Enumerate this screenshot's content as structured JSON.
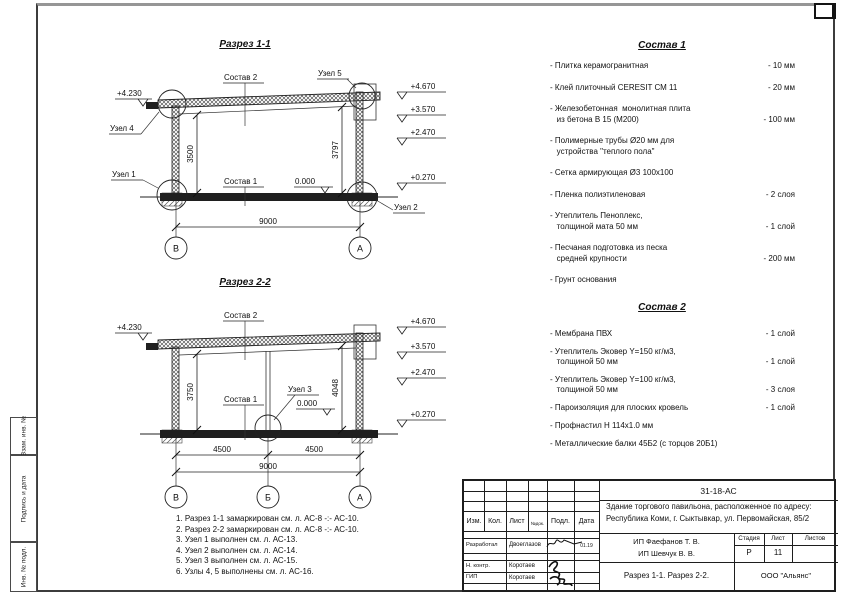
{
  "sheet": {
    "sidebar_cells": [
      "Взам. инв. №",
      "Подпись и дата",
      "Инв. № подл."
    ]
  },
  "sections": {
    "s1": {
      "title": "Разрез 1-1",
      "sostav2_label": "Состав 2",
      "sostav1_label": "Состав 1",
      "uzel5": "Узел 5",
      "uzel4": "Узел 4",
      "uzel1": "Узел 1",
      "uzel2": "Узел 2",
      "zero_mark": "0.000",
      "left_elevation": "+4.230",
      "elev1": "+4.670",
      "elev2": "+3.570",
      "elev3": "+2.470",
      "elev4": "+0.270",
      "dim_left": "3500",
      "dim_right": "3797",
      "dim_span": "9000",
      "axis_left": "В",
      "axis_right": "А"
    },
    "s2": {
      "title": "Разрез 2-2",
      "sostav2_label": "Состав 2",
      "sostav1_label": "Состав 1",
      "uzel3": "Узел 3",
      "zero_mark": "0.000",
      "left_elevation": "+4.230",
      "elev1": "+4.670",
      "elev2": "+3.570",
      "elev3": "+2.470",
      "elev4": "+0.270",
      "dim_left": "3750",
      "dim_right": "4048",
      "dim_span_l": "4500",
      "dim_span_r": "4500",
      "dim_span": "9000",
      "axis_left": "В",
      "axis_mid": "Б",
      "axis_right": "А"
    }
  },
  "sostav1": {
    "title": "Состав 1",
    "items": [
      {
        "name": "- Плитка керамогранитная",
        "value": "- 10 мм"
      },
      {
        "name": "- Клей плиточный CERESIT СМ 11",
        "value": "- 20 мм"
      },
      {
        "name": "- Железобетонная  монолитная плита\n   из бетона В 15 (М200)",
        "value": "- 100 мм"
      },
      {
        "name": "- Полимерные трубы Ø20 мм для\n   устройства \"теплого пола\"",
        "value": ""
      },
      {
        "name": "- Сетка армирующая Ø3 100x100",
        "value": ""
      },
      {
        "name": "- Пленка полиэтиленовая",
        "value": "- 2 слоя"
      },
      {
        "name": "- Утеплитель Пеноплекс,\n   толщиной мата 50 мм",
        "value": "- 1 слой"
      },
      {
        "name": "- Песчаная подготовка из песка\n   средней крупности",
        "value": "- 200 мм"
      },
      {
        "name": "- Грунт основания",
        "value": ""
      }
    ]
  },
  "sostav2": {
    "title": "Состав 2",
    "items": [
      {
        "name": "- Мембрана ПВХ",
        "value": "- 1 слой"
      },
      {
        "name": "- Утеплитель Эковер Y=150 кг/м3,\n   толщиной 50 мм",
        "value": "- 1 слой"
      },
      {
        "name": "- Утеплитель Эковер Y=100 кг/м3,\n   толщиной 50 мм",
        "value": "- 3 слоя"
      },
      {
        "name": "- Пароизоляция для плоских кровель",
        "value": "- 1 слой"
      },
      {
        "name": "- Профнастил Н 114x1.0 мм",
        "value": ""
      },
      {
        "name": "- Металлические балки 45Б2 (с торцов 20Б1)",
        "value": ""
      }
    ]
  },
  "notes": [
    "1. Разрез 1-1 замаркирован см. л. АС-8 -:- АС-10.",
    "2. Разрез 2-2 замаркирован см. л. АС-8 -:- АС-10.",
    "3. Узел 1 выполнен см. л. АС-13.",
    "4. Узел 2 выполнен см. л. АС-14.",
    "5. Узел 3 выполнен см. л. АС-15.",
    "6. Узлы 4, 5 выполнены см. л. АС-16."
  ],
  "titleblock": {
    "doc_number": "31-18-АС",
    "project_line1": "Здание торгового павильона, расположенное по адресу:",
    "project_line2": "Республика Коми, г. Сыктывкар, ул. Первомайская, 85/2",
    "col_headers": {
      "izm": "Изм.",
      "kol": "Кол.",
      "list": "Лист",
      "ndok": "№док.",
      "podp": "Подл.",
      "data": "Дата"
    },
    "rows": [
      {
        "role": "Разработал",
        "name": "Двоеглазов",
        "date": "01.19"
      },
      {
        "role": "Н. контр.",
        "name": "Коротаев",
        "date": ""
      },
      {
        "role": "ГИП",
        "name": "Коротаев",
        "date": ""
      }
    ],
    "client_line1": "ИП Фаефанов Т. В.",
    "client_line2": "ИП Шевчук В. В.",
    "stage_label": "Стадия",
    "sheet_label": "Лист",
    "sheets_label": "Листов",
    "stage_value": "Р",
    "sheet_value": "11",
    "sheets_value": "",
    "title": "Разрез 1-1. Разрез 2-2.",
    "company": "ООО \"Альянс\""
  }
}
